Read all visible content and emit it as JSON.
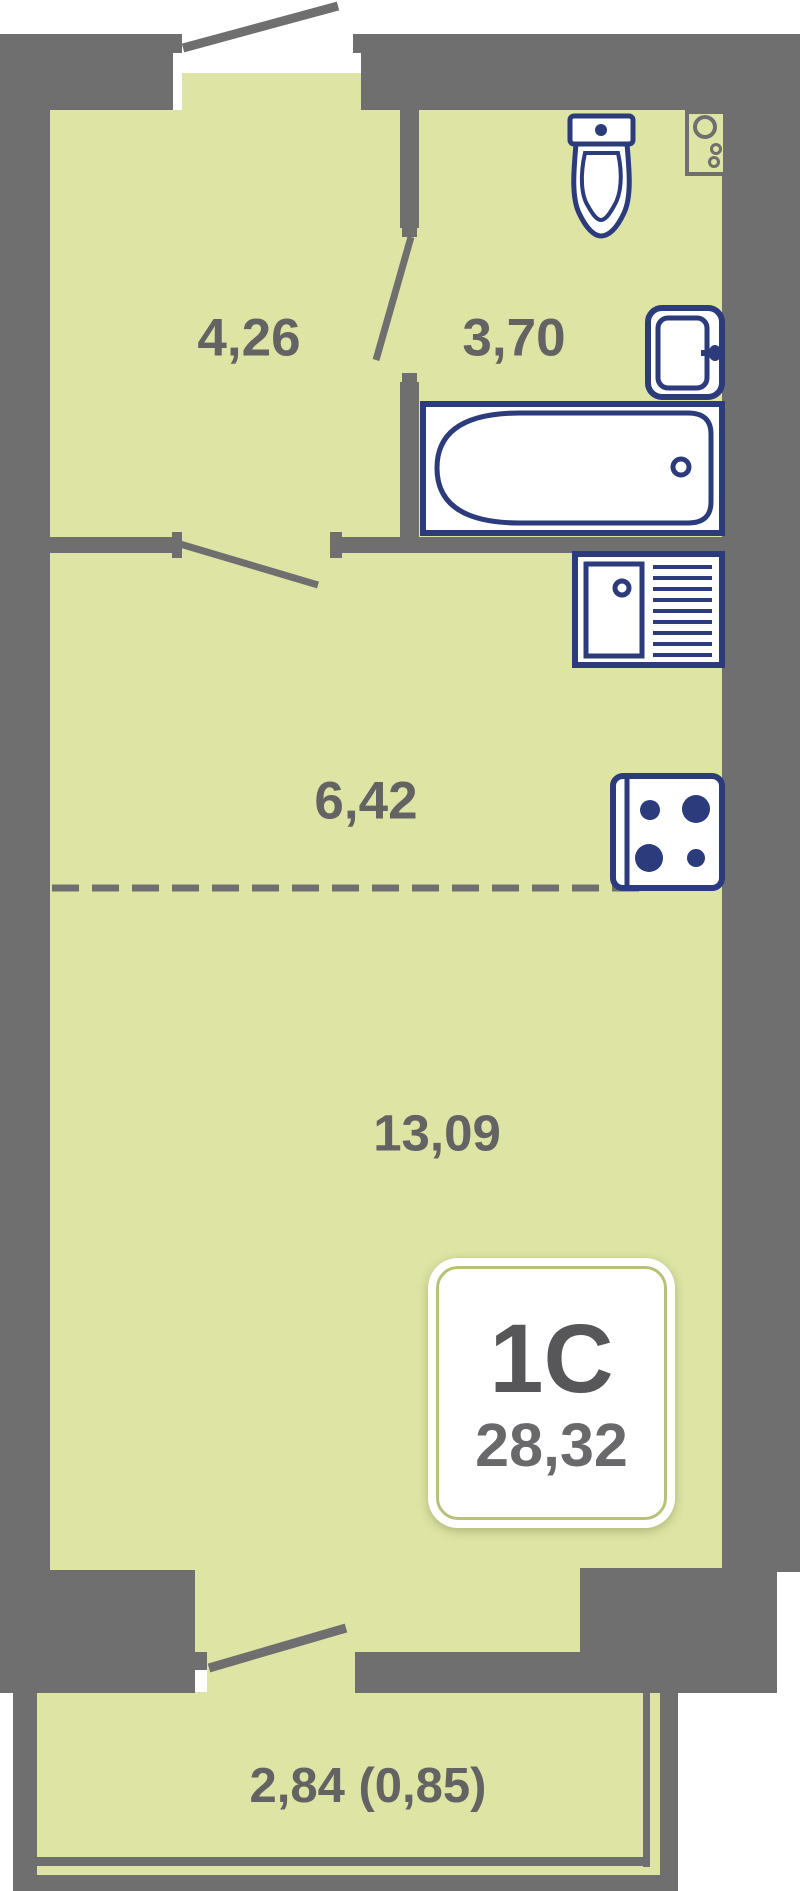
{
  "plan": {
    "type_label": "1С",
    "total_area": "28,32",
    "rooms": [
      {
        "id": "hallway",
        "area_label": "4,26"
      },
      {
        "id": "bathroom",
        "area_label": "3,70"
      },
      {
        "id": "kitchen",
        "area_label": "6,42"
      },
      {
        "id": "living-room",
        "area_label": "13,09"
      },
      {
        "id": "balcony",
        "area_label": "2,84 (0,85)"
      }
    ],
    "icons": [
      "entrance-door-icon",
      "bathroom-door-icon",
      "kitchen-door-icon",
      "balcony-door-icon",
      "toilet-icon",
      "washbasin-icon",
      "bathtub-icon",
      "kitchen-sink-icon",
      "stove-icon",
      "vent-shaft-icon"
    ],
    "colors": {
      "wall": "#6f6f6f",
      "floor": "#dde4a4",
      "fixture_outline": "#2b3b7c",
      "label_text": "#636363",
      "badge_border": "#b9c178",
      "badge_text": "#57575a"
    }
  }
}
